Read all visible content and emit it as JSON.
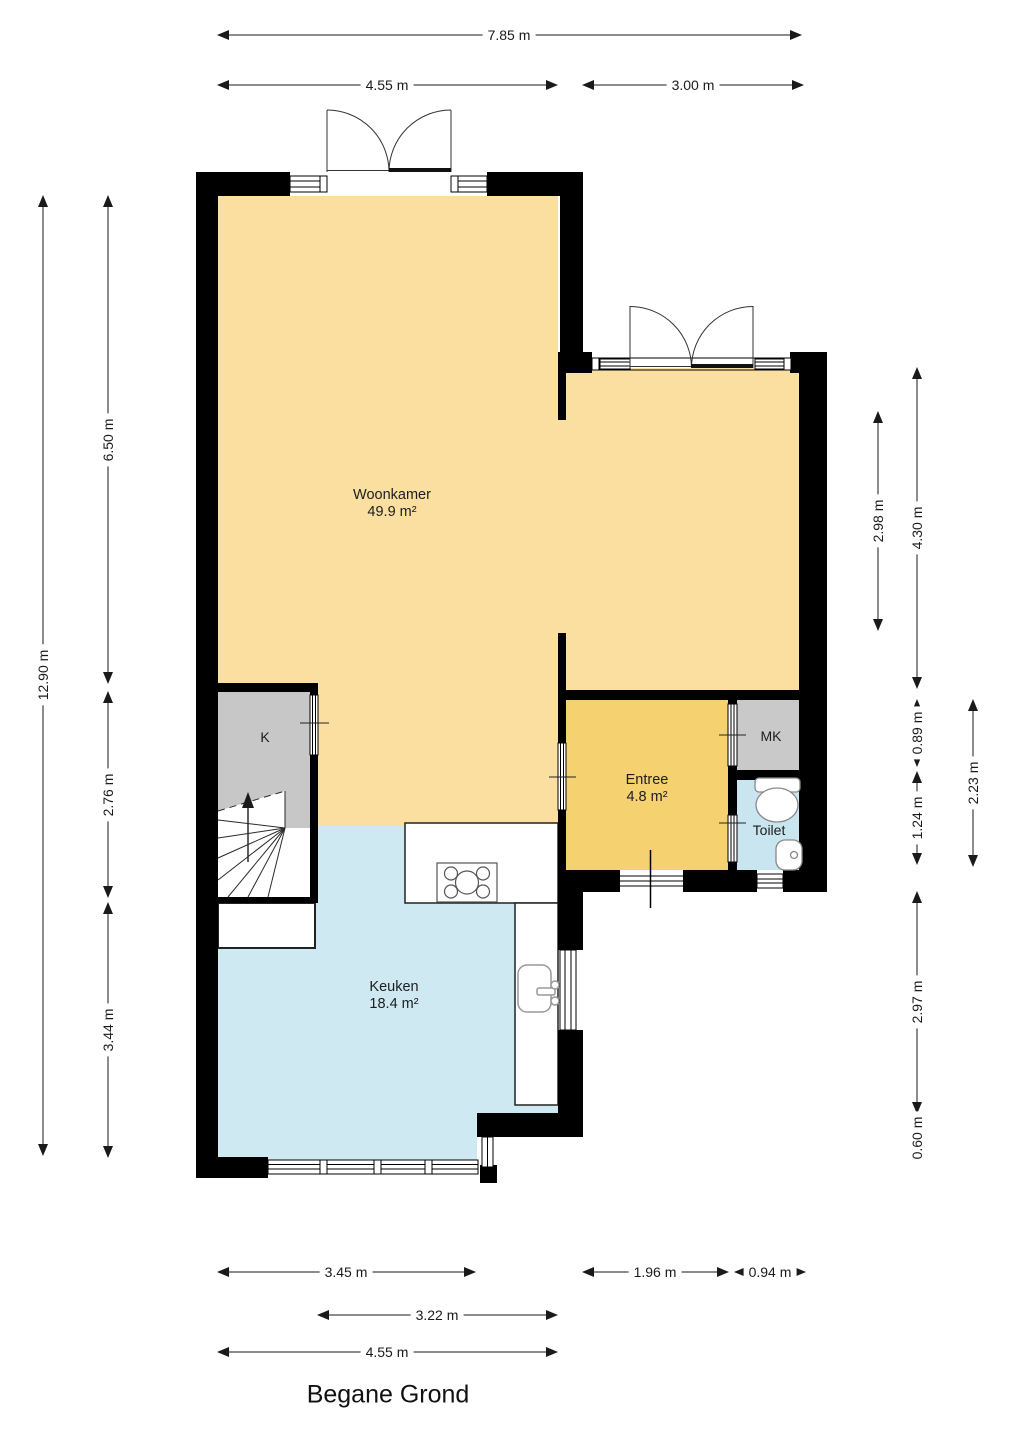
{
  "title": "Begane Grond",
  "rooms": {
    "woonkamer": {
      "name": "Woonkamer",
      "area": "49.9 m²"
    },
    "keuken": {
      "name": "Keuken",
      "area": "18.4 m²"
    },
    "entree": {
      "name": "Entree",
      "area": "4.8 m²"
    },
    "toilet": {
      "name": "Toilet"
    },
    "mk": {
      "name": "MK"
    },
    "k": {
      "name": "K"
    }
  },
  "dimensions": {
    "top": [
      "7.85 m",
      "4.55 m",
      "3.00 m"
    ],
    "left": [
      "12.90 m",
      "6.50 m",
      "2.76 m",
      "3.44 m"
    ],
    "right": [
      "2.98 m",
      "4.30 m",
      "0.89 m",
      "1.24 m",
      "2.23 m",
      "2.97 m",
      "0.60 m"
    ],
    "bottom": [
      "3.45 m",
      "1.96 m",
      "0.94 m",
      "3.22 m",
      "4.55 m"
    ]
  },
  "colors": {
    "wall": "#000000",
    "woonkamer": "#FBDFA1",
    "entree": "#F5D170",
    "keuken": "#CFE9F2",
    "toilet": "#C9E6F0",
    "closet_k": "#C7C7C7",
    "closet_mk": "#C9C9C9"
  }
}
